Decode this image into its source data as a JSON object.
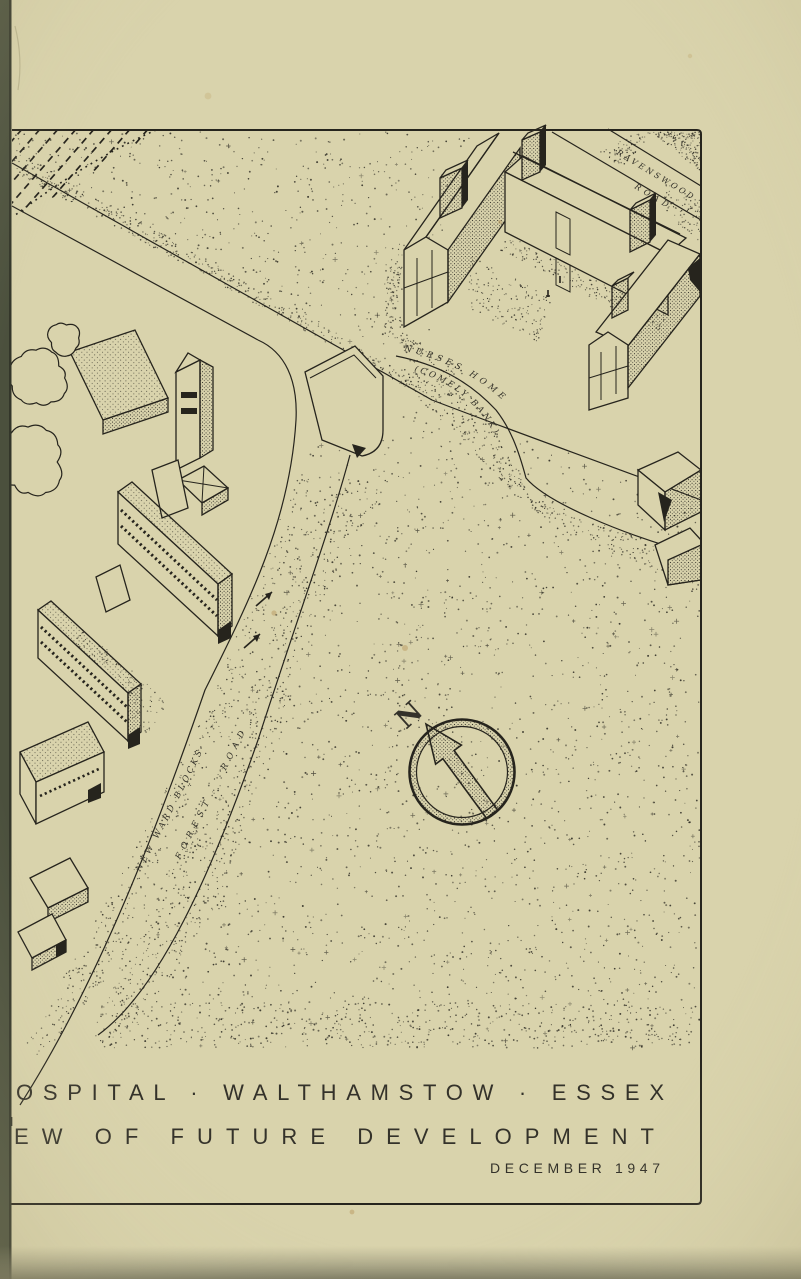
{
  "title_block": {
    "caption_line1": "OSPITAL · WALTHAMSTOW · ESSEX",
    "caption_line2": "EW OF FUTURE DEVELOPMENT",
    "date": "DECEMBER 1947",
    "edge_fragment_1": "N",
    "edge_fragment_2": "I."
  },
  "map_labels": {
    "north_indicator": "N",
    "road_top_right_line1": "RAVENSWOOD",
    "road_top_right_line2": "ROAD",
    "main_road": "FOREST ROAD",
    "ward_blocks_label": "NEW WARD BLOCKS",
    "nurses_home_line1": "NURSES HOME",
    "nurses_home_line2": "(COMELY BANK)"
  },
  "colors": {
    "paper": "#d9d3ac",
    "ink": "#26241d",
    "binding_edge": "#4b503d",
    "stain": "#b08948"
  }
}
